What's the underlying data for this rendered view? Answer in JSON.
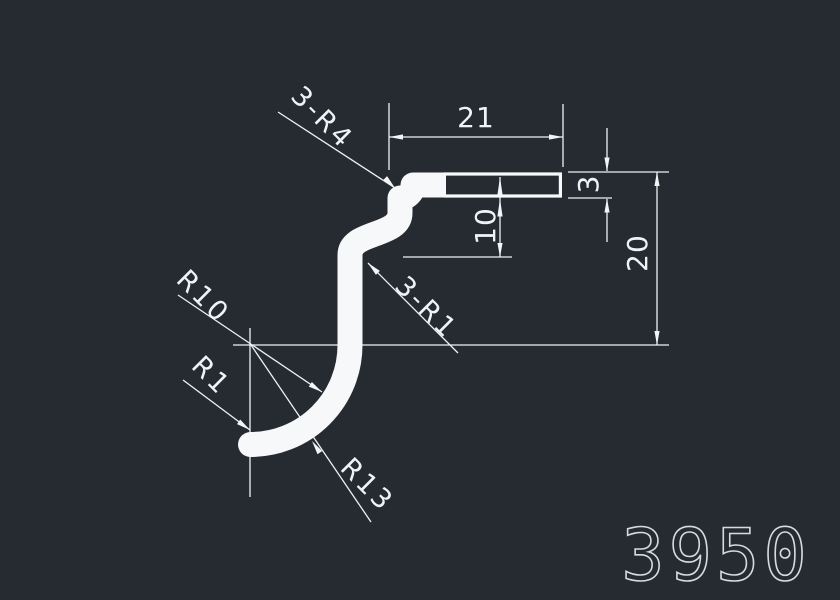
{
  "colors": {
    "background": "#262b31",
    "thin_lines": "#eef1f3",
    "profile": "#f6f8f9",
    "dimension_text": "#f0f3f5",
    "part_number_text": "#d7dade"
  },
  "drawing": {
    "dimensions": {
      "top_width": "21",
      "right_thickness": "3",
      "step_height": "10",
      "overall_height": "20"
    },
    "radius_labels": {
      "top_corner": "3-R4",
      "step_corner": "3-R1",
      "hook_inner": "R10",
      "tip": "R1",
      "hook_outer": "R13"
    },
    "part_number": "3950"
  }
}
